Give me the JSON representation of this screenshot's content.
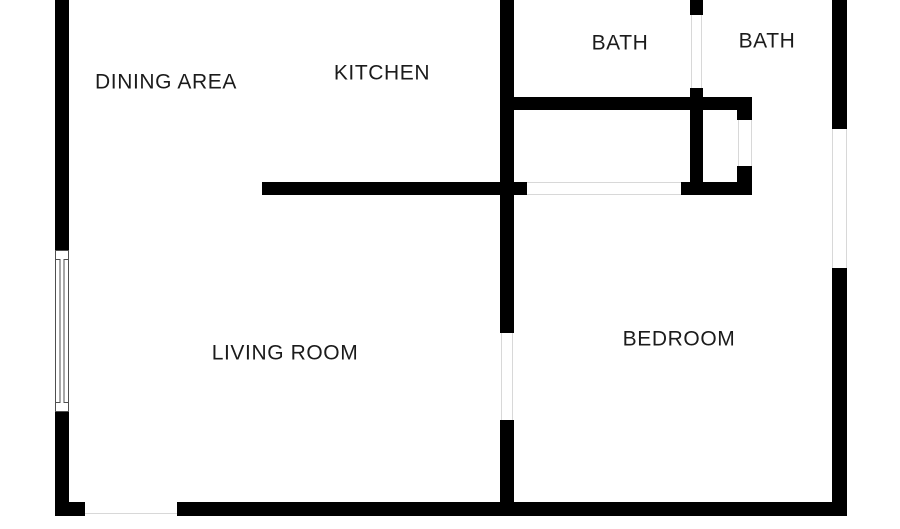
{
  "page": {
    "background": "#ffffff",
    "width": 900,
    "height": 529
  },
  "colors": {
    "wall": "#000000",
    "opening_line": "#d8d8d8",
    "window_line": "#4f4f4f",
    "label_text": "#1b1b1b"
  },
  "floorplan": {
    "labels": [
      {
        "id": "dining-area",
        "text": "DINING AREA",
        "cx": 166,
        "cy": 82
      },
      {
        "id": "kitchen",
        "text": "KITCHEN",
        "cx": 382,
        "cy": 73
      },
      {
        "id": "bath-left",
        "text": "BATH",
        "cx": 620,
        "cy": 43
      },
      {
        "id": "bath-right",
        "text": "BATH",
        "cx": 767,
        "cy": 41
      },
      {
        "id": "living-room",
        "text": "LIVING ROOM",
        "cx": 285,
        "cy": 353
      },
      {
        "id": "bedroom",
        "text": "BEDROOM",
        "cx": 679,
        "cy": 339
      }
    ],
    "walls": [
      {
        "name": "left-exterior-wall-upper",
        "x": 55,
        "y": 0,
        "w": 14,
        "h": 250
      },
      {
        "name": "left-exterior-wall-lower",
        "x": 55,
        "y": 412,
        "w": 14,
        "h": 104
      },
      {
        "name": "bottom-wall-left-foot",
        "x": 55,
        "y": 502,
        "w": 30,
        "h": 14
      },
      {
        "name": "bottom-exterior-wall",
        "x": 177,
        "y": 502,
        "w": 670,
        "h": 14
      },
      {
        "name": "right-exterior-wall-upper",
        "x": 832,
        "y": 0,
        "w": 15,
        "h": 129
      },
      {
        "name": "right-exterior-wall-lower",
        "x": 832,
        "y": 268,
        "w": 15,
        "h": 248
      },
      {
        "name": "center-wall-upper",
        "x": 500,
        "y": 0,
        "w": 14,
        "h": 333
      },
      {
        "name": "center-wall-lower",
        "x": 500,
        "y": 420,
        "w": 14,
        "h": 96
      },
      {
        "name": "kitchen-south-wall",
        "x": 262,
        "y": 182,
        "w": 265,
        "h": 13
      },
      {
        "name": "bath-divider-stub",
        "x": 690,
        "y": 0,
        "w": 13,
        "h": 15
      },
      {
        "name": "bath-divider-wall",
        "x": 690,
        "y": 88,
        "w": 13,
        "h": 107
      },
      {
        "name": "baths-south-wall",
        "x": 500,
        "y": 97,
        "w": 252,
        "h": 13
      },
      {
        "name": "closet-right-stub-upper",
        "x": 737,
        "y": 110,
        "w": 15,
        "h": 10
      },
      {
        "name": "closet-south-wall",
        "x": 681,
        "y": 182,
        "w": 71,
        "h": 13
      },
      {
        "name": "closet-right-stub-lower",
        "x": 737,
        "y": 166,
        "w": 15,
        "h": 16
      }
    ],
    "openings": [
      {
        "name": "entry-opening-line",
        "x": 85,
        "y": 513,
        "w": 92,
        "h": 1.4
      },
      {
        "name": "hallway-opening-top-line",
        "x": 527,
        "y": 182,
        "w": 154,
        "h": 1.4
      },
      {
        "name": "hallway-opening-bottom-line",
        "x": 527,
        "y": 193.6,
        "w": 154,
        "h": 1.4
      },
      {
        "name": "bedroom-door-line-left",
        "x": 500.5,
        "y": 333,
        "w": 1.4,
        "h": 87
      },
      {
        "name": "bedroom-door-line-right",
        "x": 512,
        "y": 333,
        "w": 1.4,
        "h": 87
      },
      {
        "name": "bath-door-line-left",
        "x": 690.5,
        "y": 15,
        "w": 1.4,
        "h": 73
      },
      {
        "name": "bath-door-line-right",
        "x": 701,
        "y": 15,
        "w": 1.4,
        "h": 73
      },
      {
        "name": "closet-opening-line-left",
        "x": 737.5,
        "y": 120,
        "w": 1.4,
        "h": 46
      },
      {
        "name": "closet-opening-line-right",
        "x": 750.5,
        "y": 120,
        "w": 1.4,
        "h": 46
      },
      {
        "name": "patio-opening-line-left",
        "x": 832,
        "y": 129,
        "w": 1.4,
        "h": 139
      },
      {
        "name": "patio-opening-line-right",
        "x": 845.5,
        "y": 129,
        "w": 1.4,
        "h": 139
      }
    ],
    "windows": [
      {
        "name": "living-room-window",
        "x": 55,
        "y": 250,
        "w": 14,
        "h": 162,
        "cap": 8
      }
    ]
  }
}
